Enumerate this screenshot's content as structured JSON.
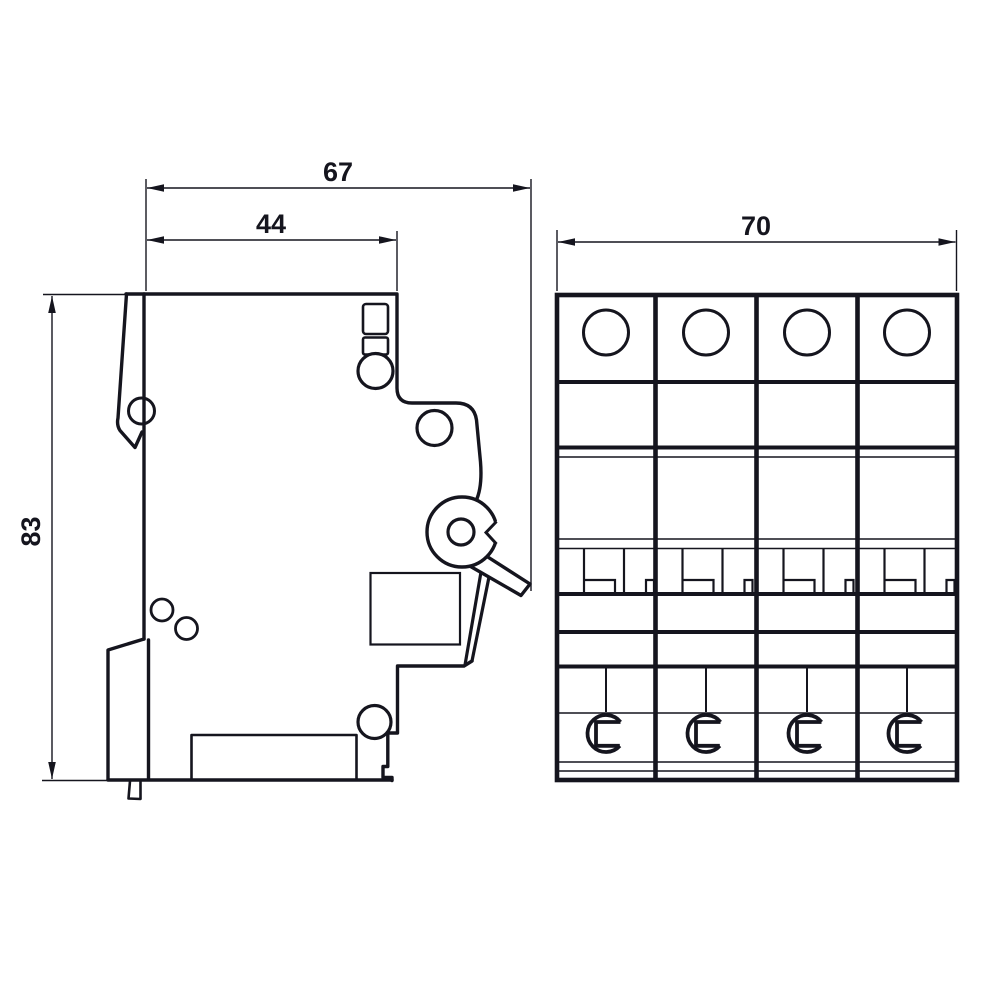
{
  "page": {
    "background": "#ffffff"
  },
  "drawing": {
    "stroke_color": "#15151e",
    "fill_color": "#ffffff",
    "side_view": {
      "dim_overall_depth": "67",
      "dim_body_depth": "44",
      "dim_height": "83"
    },
    "front_view": {
      "dim_width": "70"
    }
  }
}
